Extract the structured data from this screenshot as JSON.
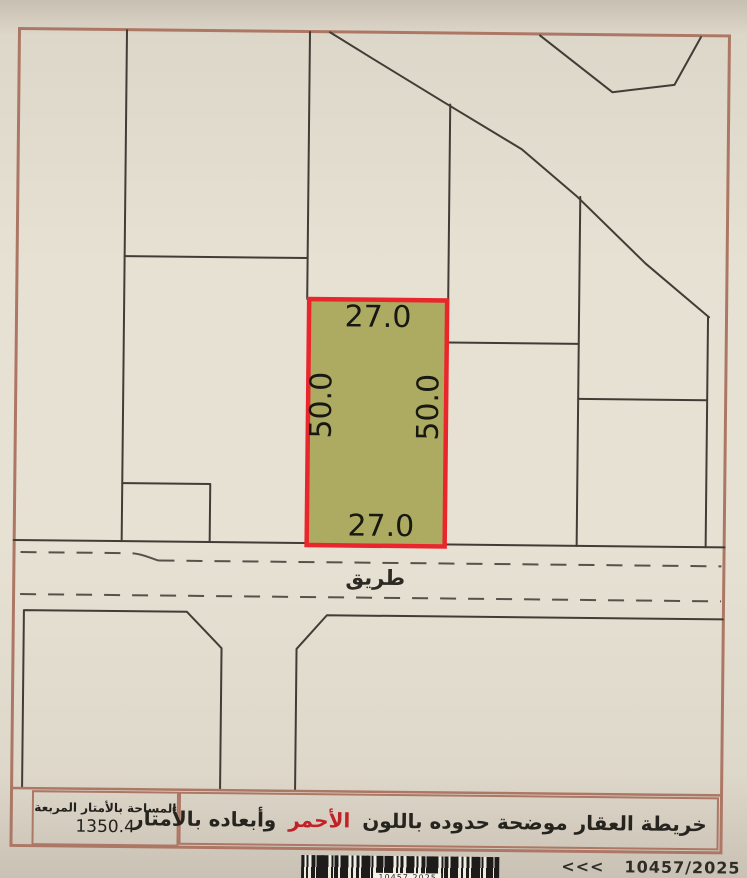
{
  "map": {
    "plot": {
      "dimensions": {
        "top": "27.0",
        "bottom": "27.0",
        "left": "50.0",
        "right": "50.0"
      },
      "fill_color": "#adaa61",
      "border_color": "#e8262c"
    },
    "road_label": "طريق"
  },
  "info_panel": {
    "area_box": {
      "title": "المساحة بالأمتار المربعة",
      "value": "1350.4"
    },
    "note": {
      "text_before_red": "خريطة العقار موضحة حدوده باللون",
      "red_word": "الأحمر",
      "text_after_red": "وأبعاده بالأمتار",
      "red_color": "#c22127"
    }
  },
  "footer": {
    "barcode_label": "10457 2025",
    "ref": {
      "left_arrows": "<<<",
      "number": "10457/2025",
      "right_arrows": ">>>"
    }
  },
  "colors": {
    "frame": "#ad7765",
    "paper": "#e7e1d3",
    "parcel_line": "#403d36"
  }
}
